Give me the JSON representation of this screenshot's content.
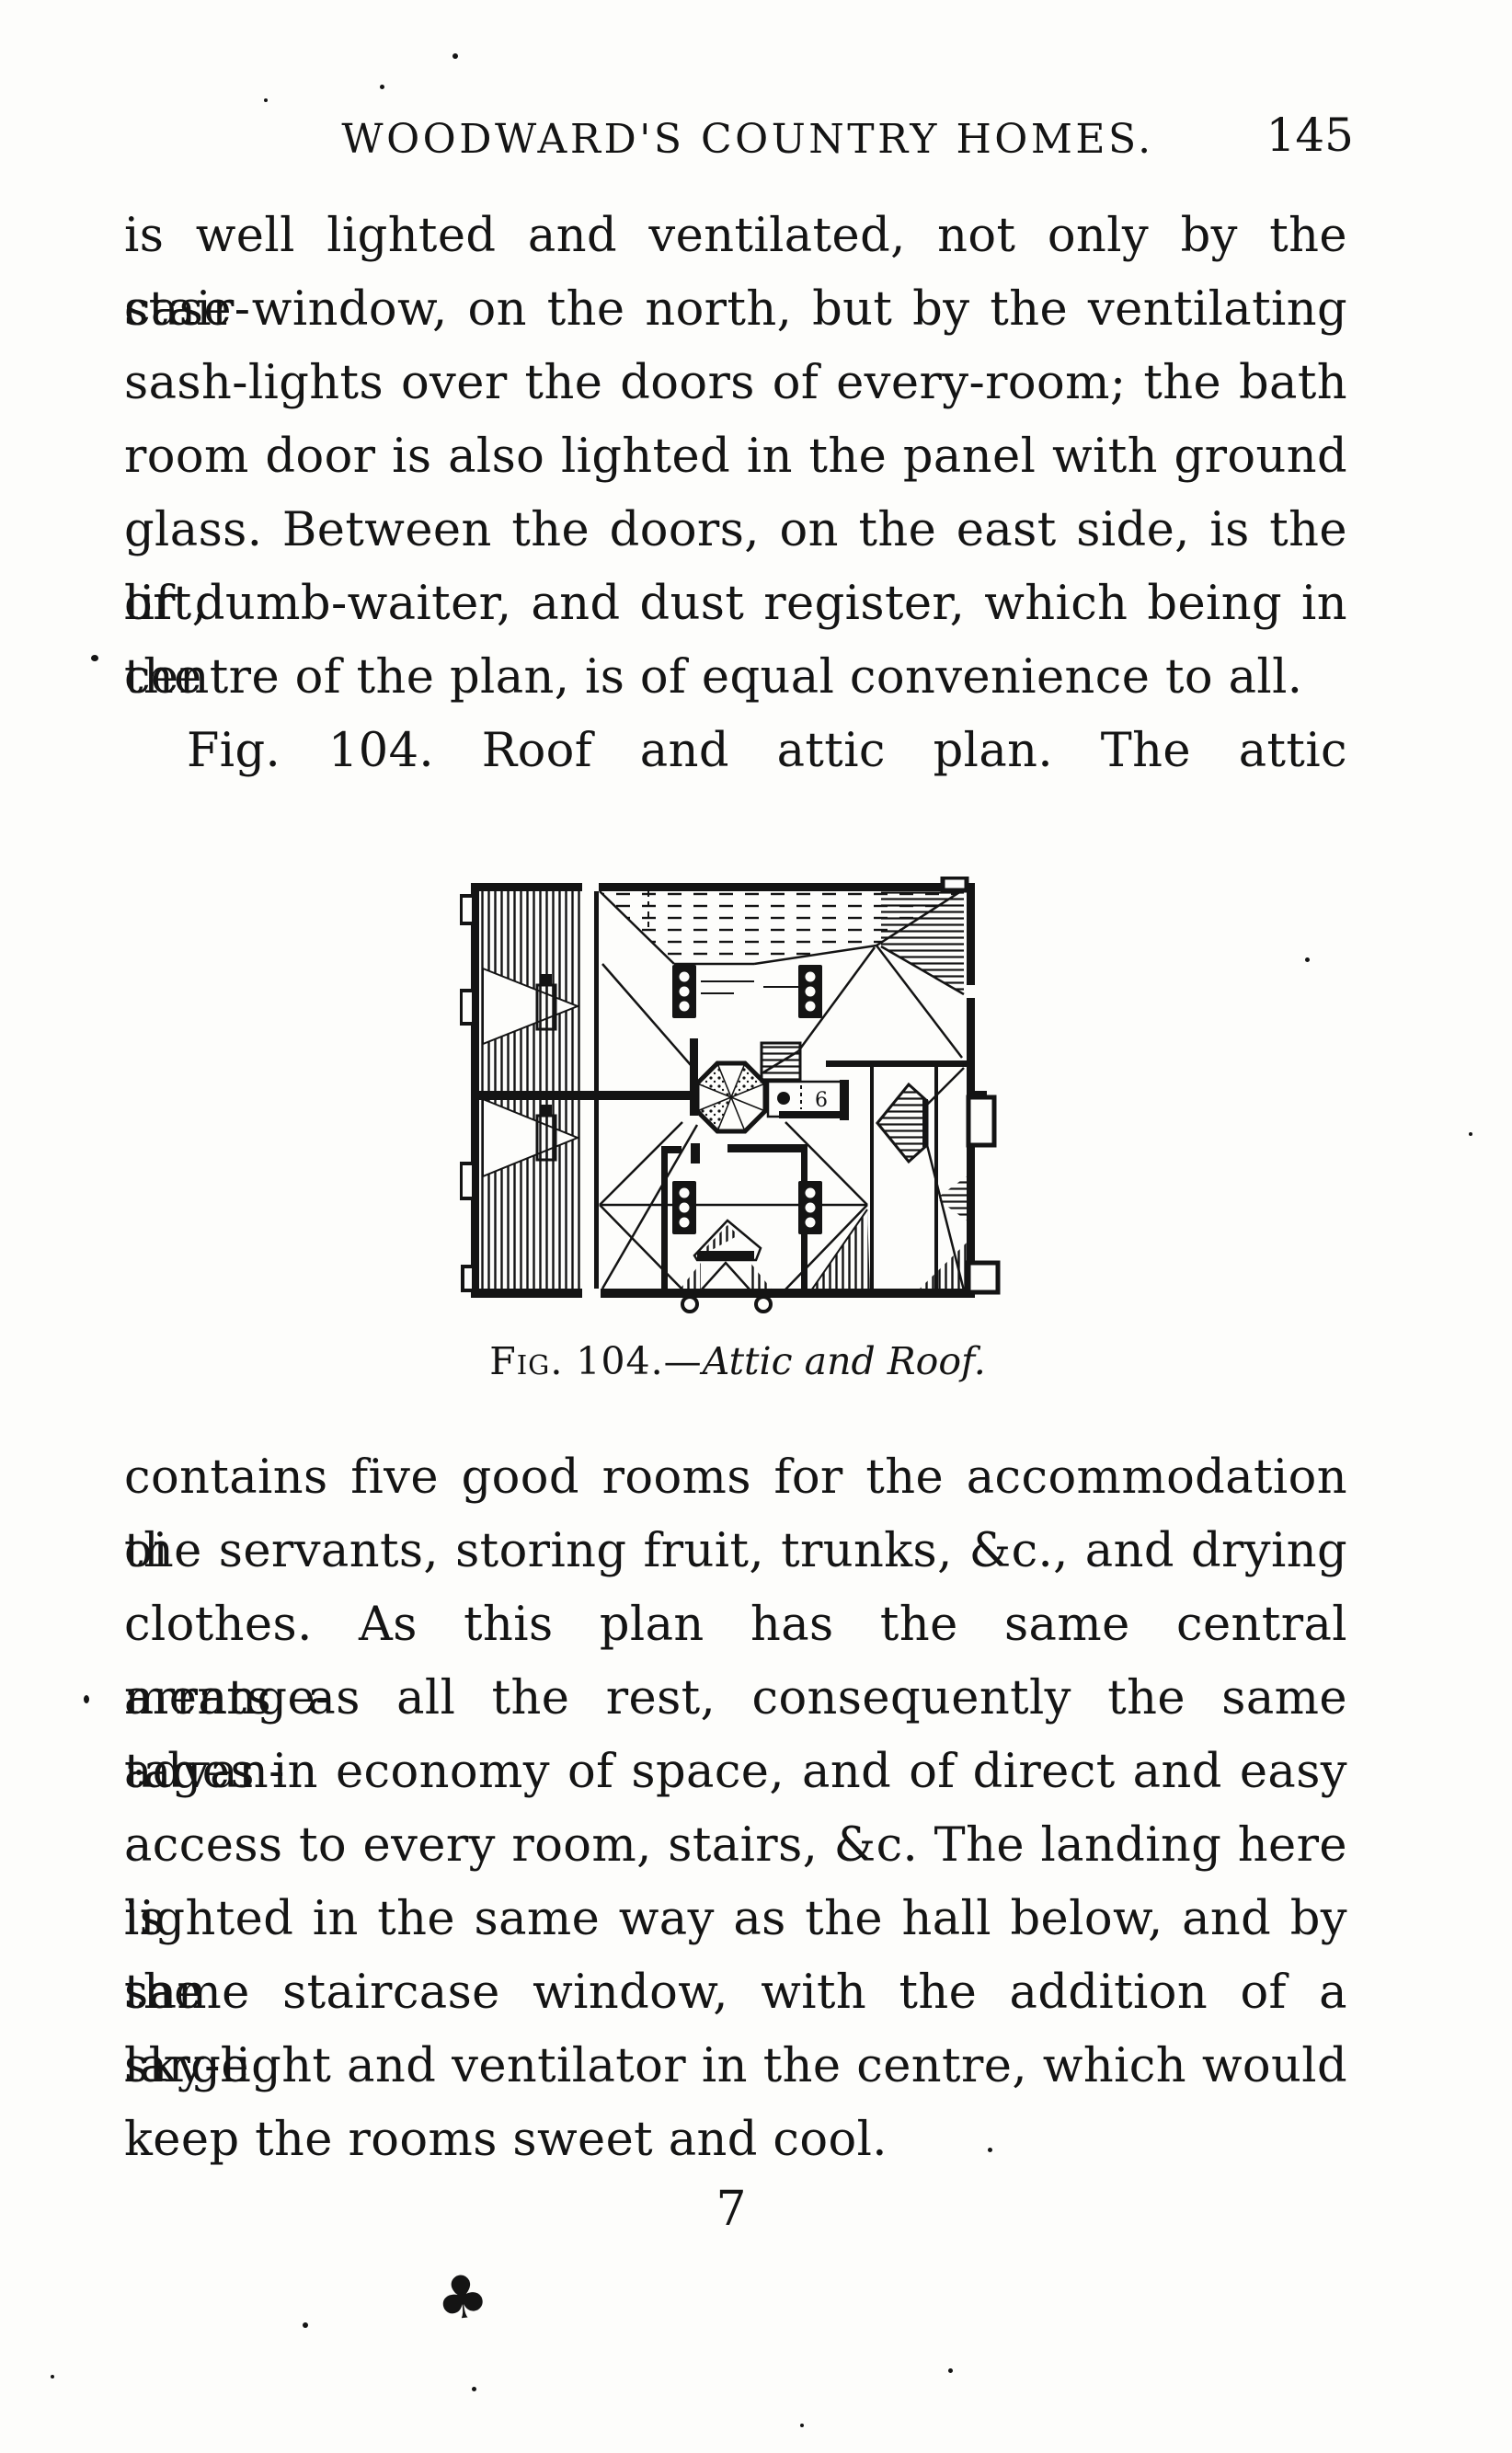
{
  "header": {
    "title": "WOODWARD'S COUNTRY HOMES.",
    "page_number": "145"
  },
  "para1": {
    "lines": [
      "is well lighted and ventilated, not only by the stair-",
      "case window, on the north, but by the ventilating",
      "sash-lights over the doors of every-room; the bath",
      "room door is also lighted in the panel with ground",
      "glass.  Between the doors, on the east side, is the lift,",
      "or dumb-waiter, and dust register, which being in the",
      "centre of the plan, is of equal convenience to all."
    ]
  },
  "fig_intro": {
    "text": "Fig. 104. Roof and attic plan. The attic"
  },
  "figure": {
    "caption_label": "Fig. 104.—",
    "caption_title": "Attic and Roof."
  },
  "para2": {
    "lines": [
      "contains five good rooms for the accommodation oi",
      "the servants, storing fruit, trunks, &c., and drying",
      "clothes.  As this plan has the same central arrange-",
      "ments as all the rest, consequently the same advan-",
      "tages in economy of space, and of direct and easy",
      "access to every room, stairs, &c.  The landing here is",
      "lighted in the same way as the hall below, and by the",
      "same staircase window, with the addition of a large",
      "sky-light and ventilator in the centre, which would",
      "keep the rooms sweet and cool."
    ]
  },
  "footer": {
    "signature": "7",
    "ink_mark": "♣"
  },
  "colors": {
    "ink": "#141414",
    "paper": "#fdfdfb"
  }
}
